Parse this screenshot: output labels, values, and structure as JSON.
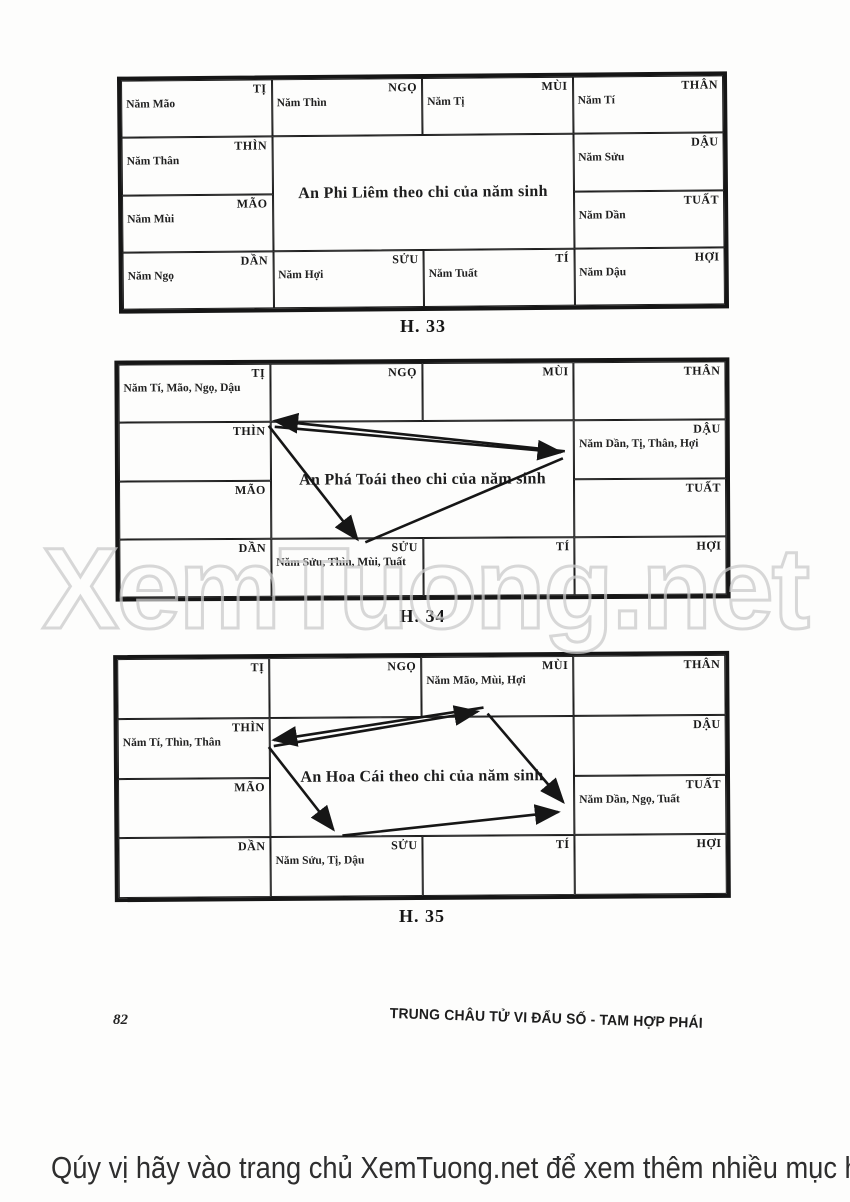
{
  "page": {
    "watermark_text": "XemTuong.net",
    "page_number": "82",
    "footer_title": "TRUNG CHÂU TỬ VI ĐẨU SỐ - TAM HỢP PHÁI",
    "bottom_banner": "Qúy vị hãy vào trang chủ XemTuong.net để xem thêm nhiều mục hay khác"
  },
  "diagrams": [
    {
      "caption": "H. 33",
      "title": "An Phi Liêm theo chi của năm sinh",
      "cells": [
        {
          "branch": "TỊ",
          "note": "Năm Mão"
        },
        {
          "branch": "NGỌ",
          "note": "Năm Thìn"
        },
        {
          "branch": "MÙI",
          "note": "Năm Tị"
        },
        {
          "branch": "THÂN",
          "note": "Năm Tí"
        },
        {
          "branch": "THÌN",
          "note": "Năm Thân"
        },
        {
          "branch": "DẬU",
          "note": "Năm Sửu"
        },
        {
          "branch": "MÃO",
          "note": "Năm Mùi"
        },
        {
          "branch": "TUẤT",
          "note": "Năm Dần"
        },
        {
          "branch": "DẦN",
          "note": "Năm Ngọ"
        },
        {
          "branch": "SỬU",
          "note": "Năm Hợi"
        },
        {
          "branch": "TÍ",
          "note": "Năm Tuất"
        },
        {
          "branch": "HỢI",
          "note": "Năm Dậu"
        }
      ],
      "arrows": []
    },
    {
      "caption": "H. 34",
      "title": "An Phá Toái theo chi của năm sinh",
      "cells": [
        {
          "branch": "TỊ",
          "note": "Năm Tí, Mão, Ngọ, Dậu"
        },
        {
          "branch": "NGỌ",
          "note": ""
        },
        {
          "branch": "MÙI",
          "note": ""
        },
        {
          "branch": "THÂN",
          "note": ""
        },
        {
          "branch": "THÌN",
          "note": ""
        },
        {
          "branch": "DẬU",
          "note": "Năm Dần, Tị, Thân, Hợi"
        },
        {
          "branch": "MÃO",
          "note": ""
        },
        {
          "branch": "TUẤT",
          "note": ""
        },
        {
          "branch": "DẦN",
          "note": ""
        },
        {
          "branch": "SỬU",
          "note": "Năm Sửu, Thìn, Mùi, Tuất"
        },
        {
          "branch": "TÍ",
          "note": ""
        },
        {
          "branch": "HỢI",
          "note": ""
        }
      ],
      "arrows": [
        {
          "from": "DẬU",
          "to": "TỊ"
        },
        {
          "from": "TỊ",
          "to": "DẬU"
        },
        {
          "from": "TỊ",
          "to": "SỬU"
        },
        {
          "from": "SỬU",
          "to": "DẬU"
        }
      ]
    },
    {
      "caption": "H. 35",
      "title": "An Hoa Cái theo chi của năm sinh",
      "cells": [
        {
          "branch": "TỊ",
          "note": ""
        },
        {
          "branch": "NGỌ",
          "note": ""
        },
        {
          "branch": "MÙI",
          "note": "Năm Mão, Mùi, Hợi"
        },
        {
          "branch": "THÂN",
          "note": ""
        },
        {
          "branch": "THÌN",
          "note": "Năm Tí, Thìn, Thân"
        },
        {
          "branch": "DẬU",
          "note": ""
        },
        {
          "branch": "MÃO",
          "note": ""
        },
        {
          "branch": "TUẤT",
          "note": "Năm Dần, Ngọ, Tuất"
        },
        {
          "branch": "DẦN",
          "note": ""
        },
        {
          "branch": "SỬU",
          "note": "Năm Sửu, Tị, Dậu"
        },
        {
          "branch": "TÍ",
          "note": ""
        },
        {
          "branch": "HỢI",
          "note": ""
        }
      ],
      "arrows": [
        {
          "from": "MÙI",
          "to": "THÌN"
        },
        {
          "from": "THÌN",
          "to": "MÙI"
        },
        {
          "from": "THÌN",
          "to": "SỬU"
        },
        {
          "from": "SỬU",
          "to": "TUẤT"
        },
        {
          "from": "MÙI",
          "to": "TUẤT"
        }
      ]
    }
  ]
}
